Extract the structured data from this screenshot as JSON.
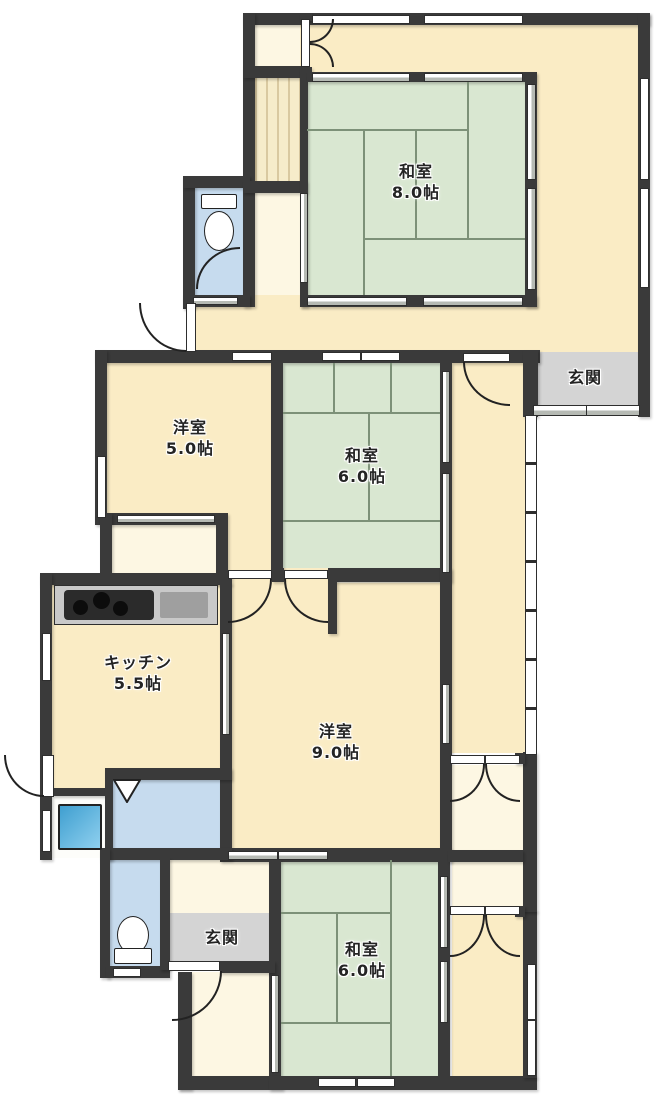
{
  "rooms": [
    {
      "id": "washitsu-8",
      "name": "和室",
      "size": "8.0帖"
    },
    {
      "id": "genkan-top",
      "name": "玄関",
      "size": ""
    },
    {
      "id": "yoshitsu-5",
      "name": "洋室",
      "size": "5.0帖"
    },
    {
      "id": "washitsu-6-mid",
      "name": "和室",
      "size": "6.0帖"
    },
    {
      "id": "kitchen",
      "name": "キッチン",
      "size": "5.5帖"
    },
    {
      "id": "yoshitsu-9",
      "name": "洋室",
      "size": "9.0帖"
    },
    {
      "id": "genkan-bottom",
      "name": "玄関",
      "size": ""
    },
    {
      "id": "washitsu-6-bottom",
      "name": "和室",
      "size": "6.0帖"
    }
  ],
  "icons": [
    "toilet-icon",
    "toilet-icon",
    "stove-icon",
    "sink-icon",
    "bathtub-icon",
    "folding-door-icon"
  ],
  "colors": {
    "wall": "#3a3a3a",
    "floor": "#faecc5",
    "floor_pale": "#fdf7e3",
    "tatami": "#d9e7d1",
    "tatami_line": "#7d9178",
    "entrance": "#d4d4d4",
    "wet": "#c6dbee",
    "counter": "#c9c9c9",
    "cooktop": "#2b2b2b",
    "sink": "#9f9f9f",
    "tub_light": "#8fd0ef",
    "tub_dark": "#3f9fd0",
    "plank": "#f6ecca",
    "plank_line": "#d9c9a0",
    "stair": "#f2eedb",
    "stair_line": "#d5cda9"
  }
}
